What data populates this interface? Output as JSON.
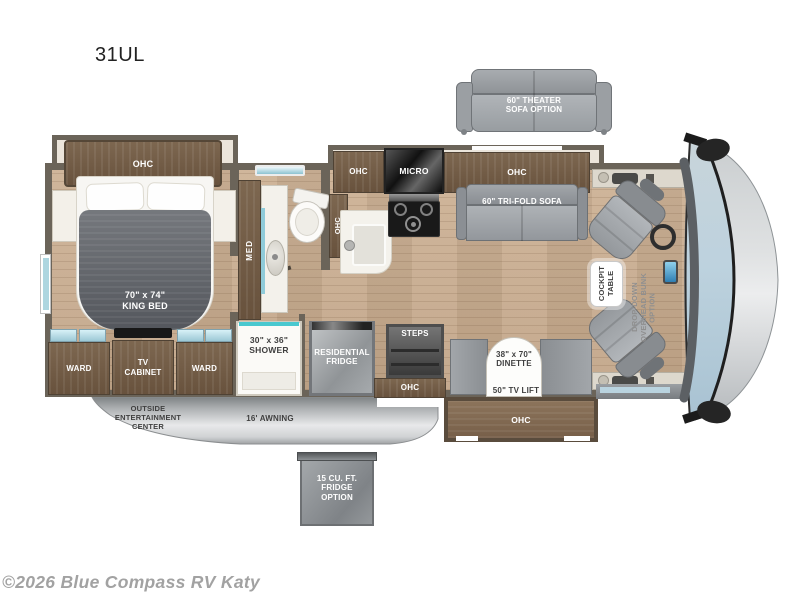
{
  "page": {
    "title": "31UL",
    "copyright": "©2026 Blue Compass RV Katy"
  },
  "colors": {
    "wall": "#6b6459",
    "cabinet_wood": "#75604b",
    "floor_wood": "#c8ad90",
    "glass_blue": "#aed6e0",
    "windshield_blue": "#b7cfdd",
    "sofa_gray": "#9ea2a6",
    "bed_gray": "#63666c",
    "skirt_gray": "#c3c6c8",
    "label_dark": "#3f3f3f",
    "copyright_gray": "#a2a2a2"
  },
  "labels": {
    "bedroom_ohc": "OHC",
    "king_bed": "70\" x 74\"\nKING BED",
    "med_cabinet": "MED",
    "hall_ohc": "OHC",
    "kitchen_ohc": "OHC",
    "micro": "MICRO",
    "living_ohc": "OHC",
    "trifold_sofa": "60\" TRI-FOLD SOFA",
    "theater_sofa_option": "60\" THEATER\nSOFA OPTION",
    "cockpit_table": "COCKPIT\nTABLE",
    "overhead_bunk_option": "DROP-DOWN\nOVERHEAD BUNK\nOPTION",
    "ward_left": "WARD",
    "tv_cabinet": "TV\nCABINET",
    "ward_right": "WARD",
    "shower": "30\" x 36\"\nSHOWER",
    "residential_fridge": "RESIDENTIAL\nFRIDGE",
    "steps": "STEPS",
    "entry_ohc": "OHC",
    "dinette": "38\" x 70\"\nDINETTE",
    "tv_lift": "50\" TV LIFT",
    "dinette_ohc": "OHC",
    "outside_entertainment": "OUTSIDE\nENTERTAINMENT\nCENTER",
    "awning": "16' AWNING",
    "fridge_option": "15 CU. FT.\nFRIDGE\nOPTION"
  }
}
